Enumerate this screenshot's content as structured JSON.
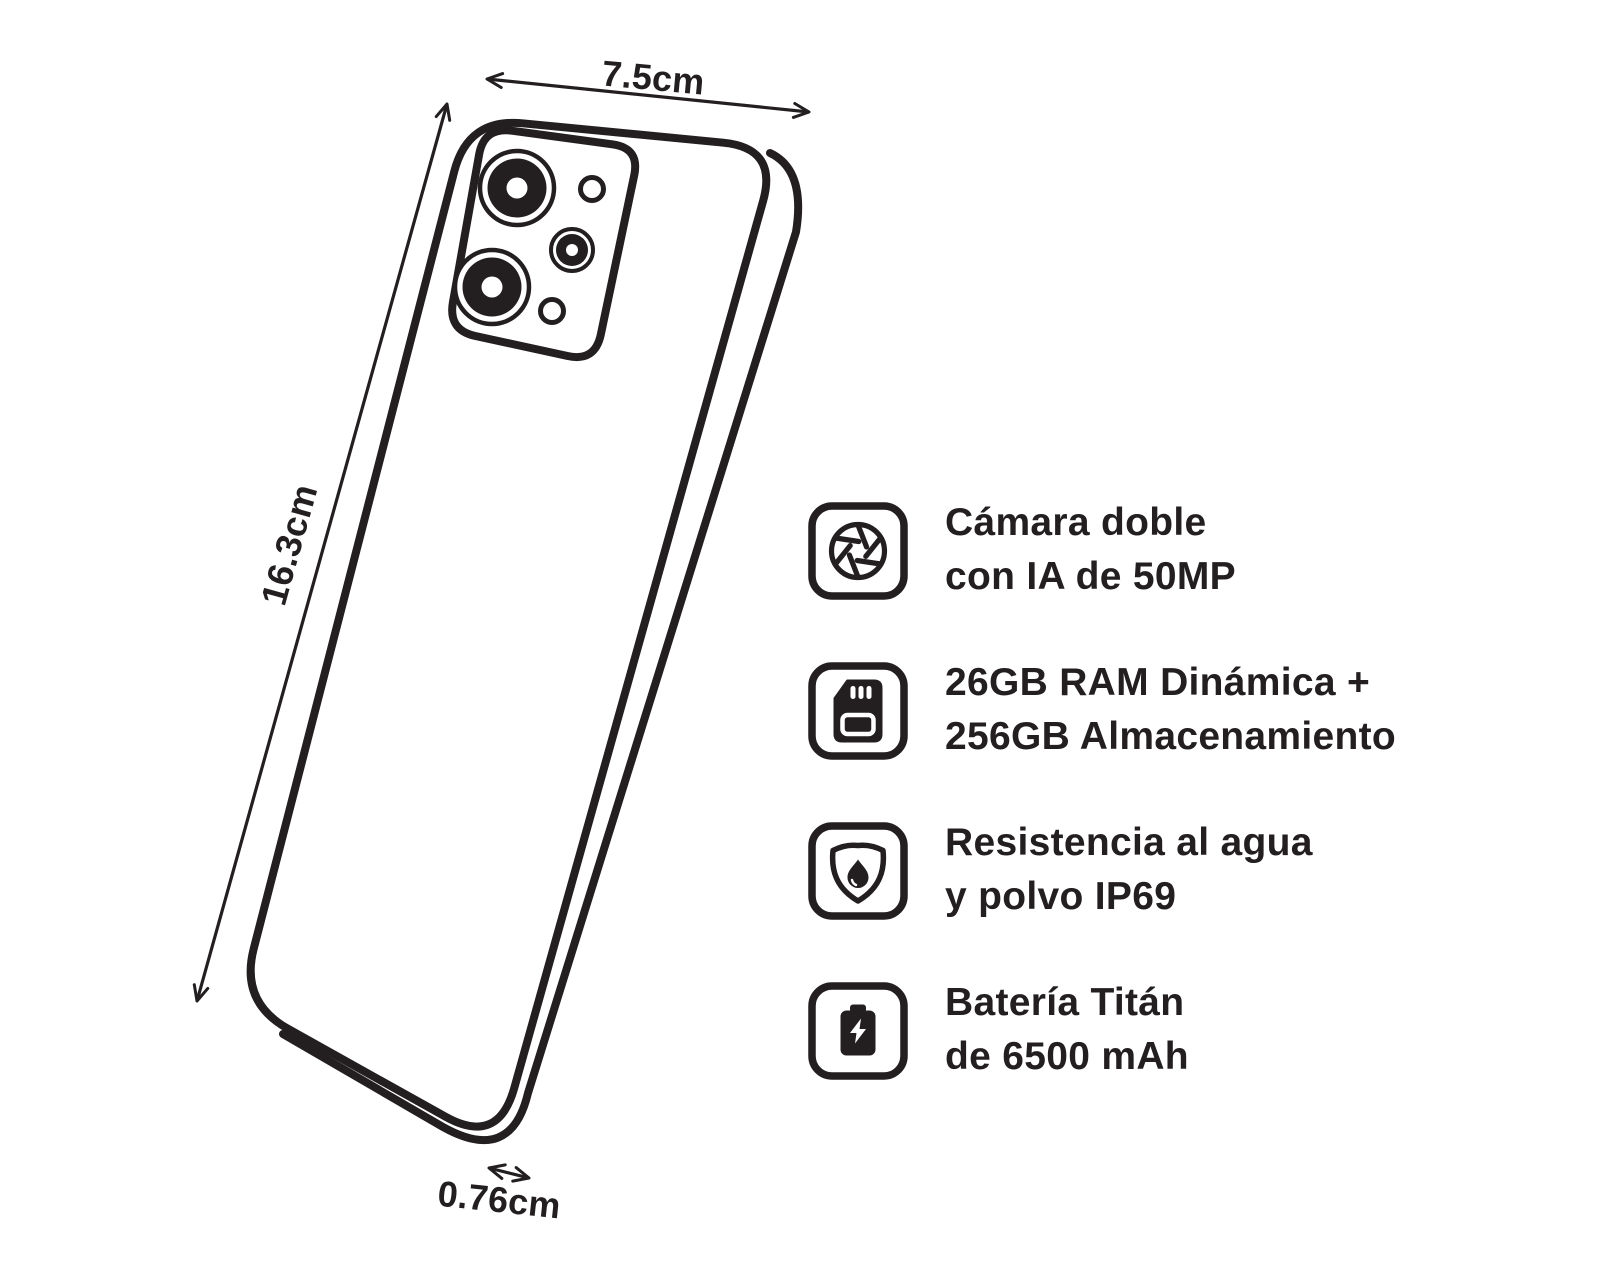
{
  "colors": {
    "ink": "#231f20",
    "background": "#ffffff"
  },
  "phone_diagram": {
    "description": "smartphone-back-three-quarter-view",
    "dimensions": {
      "width_label": "7.5cm",
      "height_label": "16.3cm",
      "depth_label": "0.76cm"
    }
  },
  "features": [
    {
      "icon": "camera-aperture-icon",
      "line1": "Cámara doble",
      "line2": "con IA de 50MP"
    },
    {
      "icon": "sd-card-icon",
      "line1": "26GB RAM Dinámica +",
      "line2": "256GB Almacenamiento"
    },
    {
      "icon": "shield-water-icon",
      "line1": "Resistencia al agua",
      "line2": "y polvo IP69"
    },
    {
      "icon": "battery-bolt-icon",
      "line1": "Batería Titán",
      "line2": "de 6500 mAh"
    }
  ]
}
